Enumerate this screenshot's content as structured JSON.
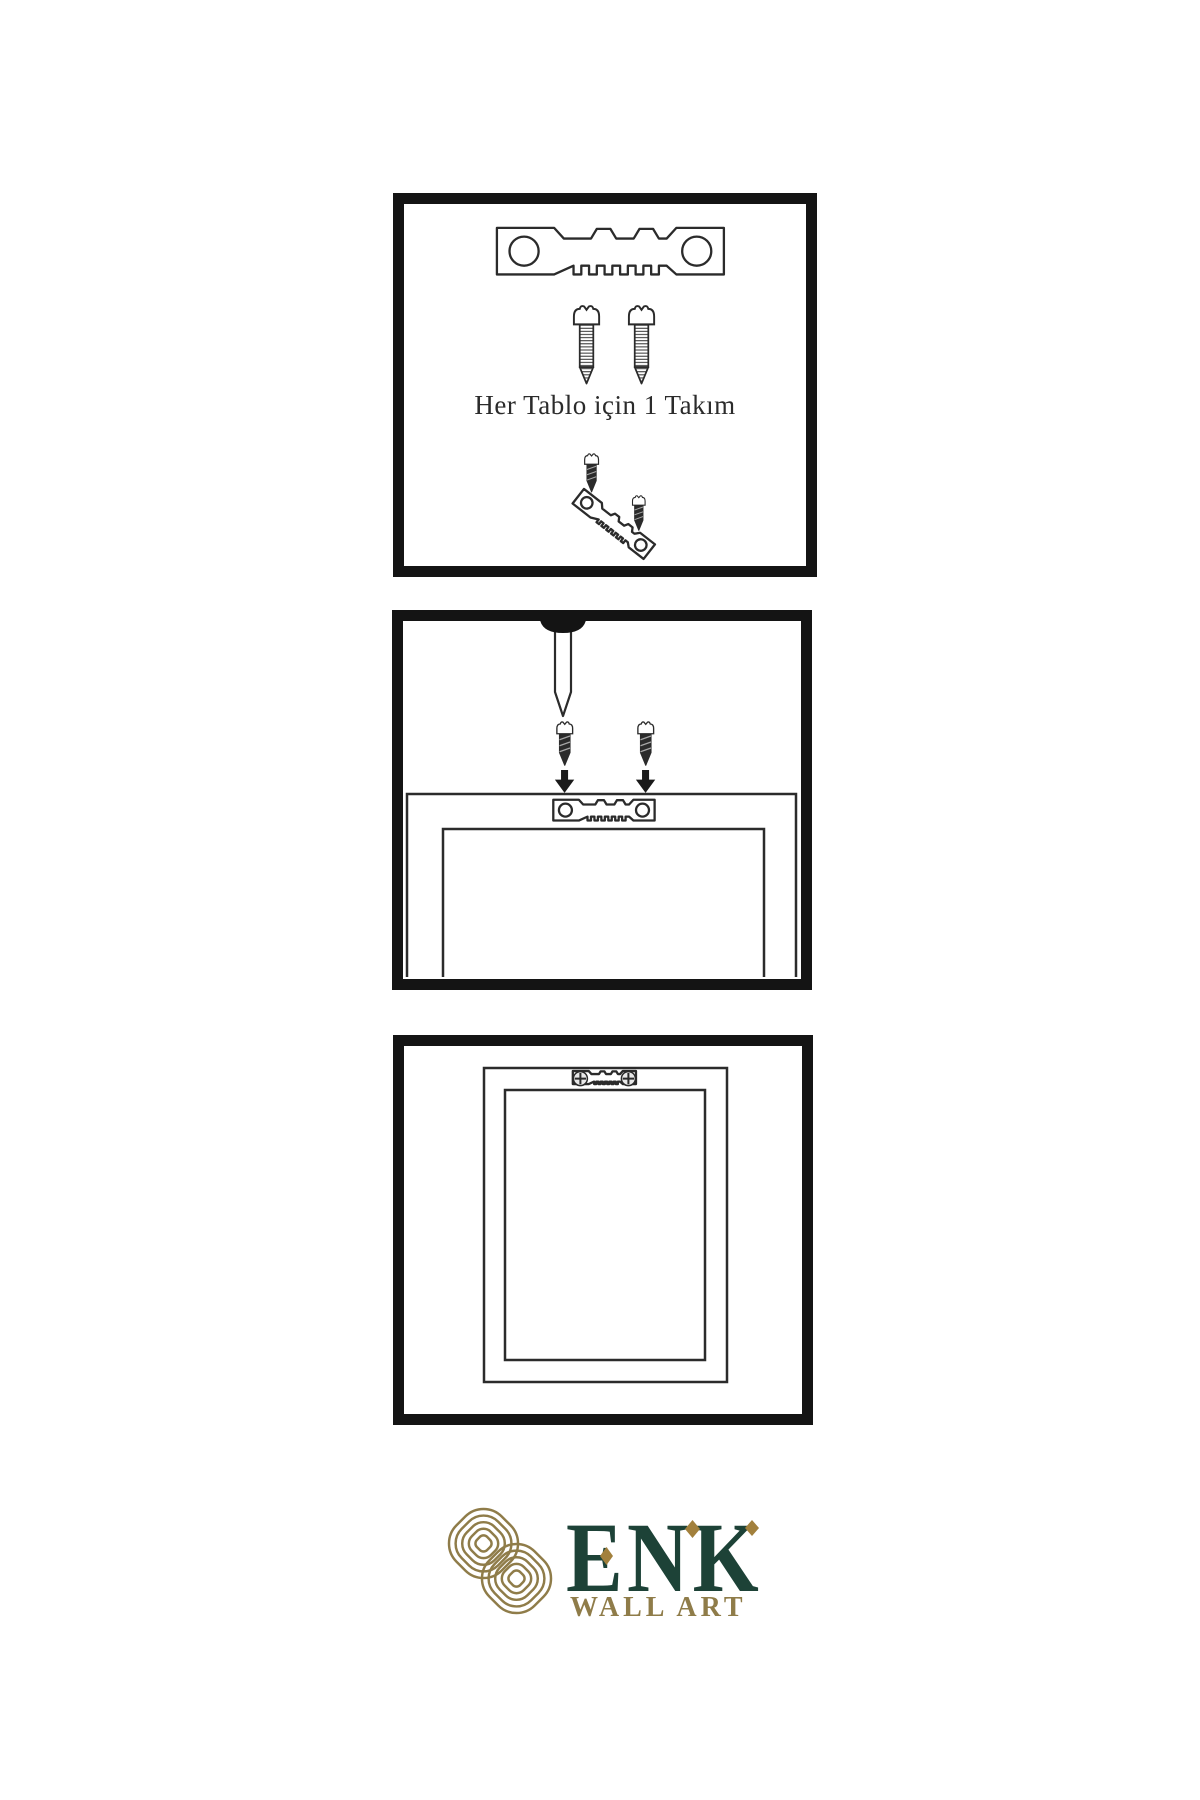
{
  "document": {
    "type": "wall-art-hanging-instructions",
    "background": "#ffffff"
  },
  "colors": {
    "ink": "#141414",
    "line": "#2b2b2b",
    "brand_green": "#1d4237",
    "brand_gold": "#8f7c49",
    "accent_bronze": "#a2803c",
    "background": "#ffffff"
  },
  "panels": {
    "kit": {
      "caption": "Her Tablo için 1 Takım",
      "contents": [
        "sawtooth-hanger-icon",
        "screw-icon",
        "screw-icon",
        "screw-dark-icon",
        "tilted-sawtooth-hanger-icon",
        "screw-dark-icon"
      ]
    },
    "mount": {
      "contents": [
        "nail-icon",
        "screw-dark-icon",
        "screw-dark-icon",
        "down-arrow-icon",
        "down-arrow-icon",
        "frame-back-outline",
        "sawtooth-hanger-icon"
      ]
    },
    "hang": {
      "contents": [
        "picture-frame-outline",
        "sawtooth-hanger-icon",
        "crosshead-screw-icon",
        "crosshead-screw-icon"
      ]
    }
  },
  "logo": {
    "brand": "ENK",
    "subtitle": "WALL ART",
    "emblem": "interlaced-knot-emblem-icon",
    "accents": [
      "diamond-accent-icon",
      "diamond-accent-icon",
      "diamond-accent-icon"
    ]
  }
}
